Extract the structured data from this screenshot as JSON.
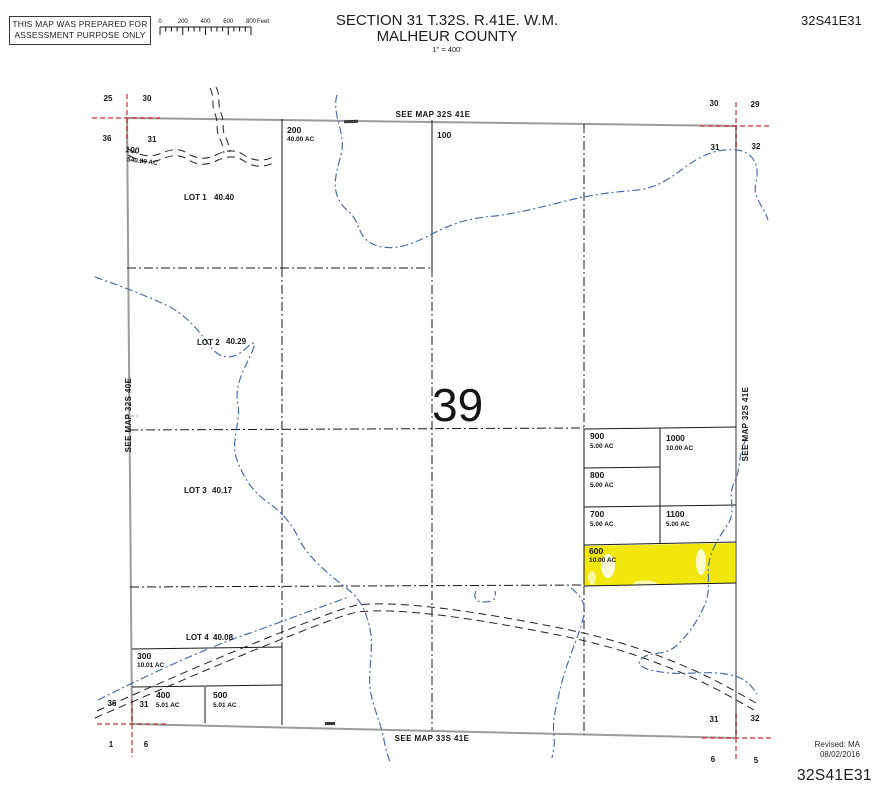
{
  "disclaimer": {
    "line1": "THIS MAP WAS PREPARED FOR",
    "line2": "ASSESSMENT PURPOSE ONLY"
  },
  "title": {
    "line1": "SECTION 31 T.32S. R.41E. W.M.",
    "line2": "MALHEUR COUNTY",
    "scale": "1\" = 400'"
  },
  "map_id": {
    "top_right": "32S41E31",
    "bottom_right": "32S41E31"
  },
  "scale_bar": {
    "labels": [
      "0",
      "200",
      "400",
      "600",
      "800"
    ],
    "unit": "Feet"
  },
  "edge_labels": {
    "top": "SEE MAP 32S 41E",
    "bottom": "SEE MAP 33S 41E",
    "left": "SEE MAP 32S 40E",
    "right": "SEE MAP 32S 41E"
  },
  "corners": {
    "top_left": {
      "nw": "25",
      "ne": "30",
      "sw": "36",
      "se": "31"
    },
    "top_right": {
      "nw": "30",
      "ne": "29",
      "sw": "31",
      "se": "32"
    },
    "bottom_left": {
      "nw": "36",
      "ne": "31",
      "sw": "1",
      "se": "6"
    },
    "bottom_right": {
      "nw": "31",
      "ne": "32",
      "sw": "6",
      "se": "5"
    }
  },
  "tax_code_area": "39",
  "parcels": {
    "p100": {
      "id": "100",
      "ac": "540.89 AC"
    },
    "p200": {
      "id": "200",
      "ac": "40.00 AC"
    },
    "p300": {
      "id": "300",
      "ac": "10.01 AC"
    },
    "p400": {
      "id": "400",
      "ac": "5.01 AC"
    },
    "p500": {
      "id": "500",
      "ac": "5.01 AC"
    },
    "p600": {
      "id": "600",
      "ac": "10.00 AC"
    },
    "p700": {
      "id": "700",
      "ac": "5.00 AC"
    },
    "p800": {
      "id": "800",
      "ac": "5.00 AC"
    },
    "p900": {
      "id": "900",
      "ac": "5.00 AC"
    },
    "p1000": {
      "id": "1000",
      "ac": "10.00 AC"
    },
    "p1100": {
      "id": "1100",
      "ac": "5.00 AC"
    }
  },
  "lots": {
    "lot1": {
      "label": "LOT 1",
      "ac": "40.40"
    },
    "lot2": {
      "label": "LOT 2",
      "ac": "40.29"
    },
    "lot3": {
      "label": "LOT 3",
      "ac": "40.17"
    },
    "lot4": {
      "label": "LOT 4",
      "ac": "40.08"
    }
  },
  "revision": {
    "label": "Revised: MA",
    "date": "08/02/2016"
  },
  "colors": {
    "highlight_yellow": "#f2e70a",
    "stream_blue": "#4a6fae",
    "corner_cross_red": "#c23330",
    "border_gray": "#9b9b9b",
    "line_black": "#1a1a1a"
  }
}
